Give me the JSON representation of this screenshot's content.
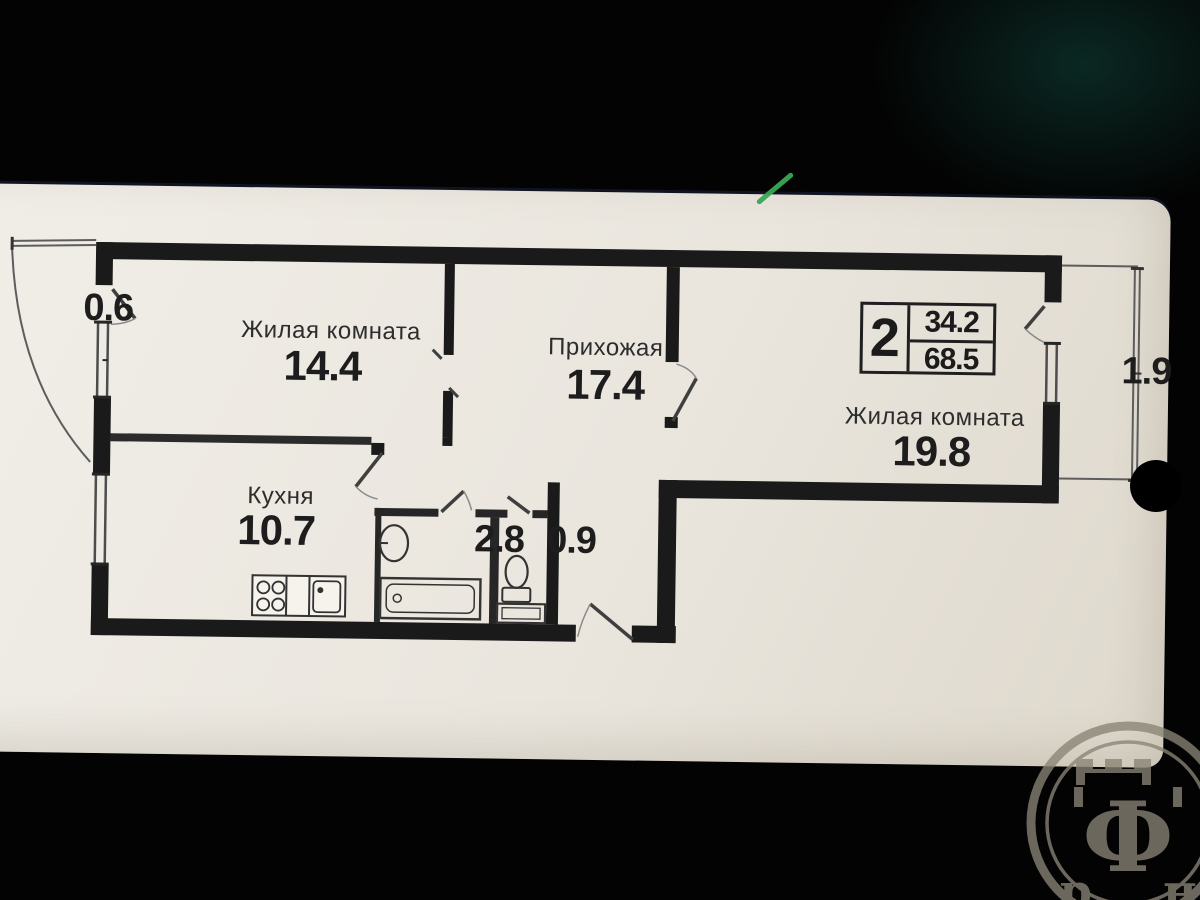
{
  "photo": {
    "background_color": "#030303",
    "paper_color": "#ece8e0",
    "line_color": "#1a1a1a",
    "green_mark_color": "#3aa654"
  },
  "legend": {
    "room_count": "2",
    "living_area": "34.2",
    "total_area": "68.5"
  },
  "rooms": {
    "living1": {
      "name": "Жилая комната",
      "area": "14.4"
    },
    "hallway": {
      "name": "Прихожая",
      "area": "17.4"
    },
    "living2": {
      "name": "Жилая комната",
      "area": "19.8"
    },
    "kitchen": {
      "name": "Кухня",
      "area": "10.7"
    },
    "bathroom": {
      "area": "2.8"
    },
    "wc": {
      "area": "0.9"
    },
    "balcony_left": {
      "area": "0.6"
    },
    "balcony_right": {
      "area": "1.9"
    }
  },
  "watermark": {
    "letter_left": "р",
    "letter_center": "Ф",
    "letter_right": "н"
  }
}
